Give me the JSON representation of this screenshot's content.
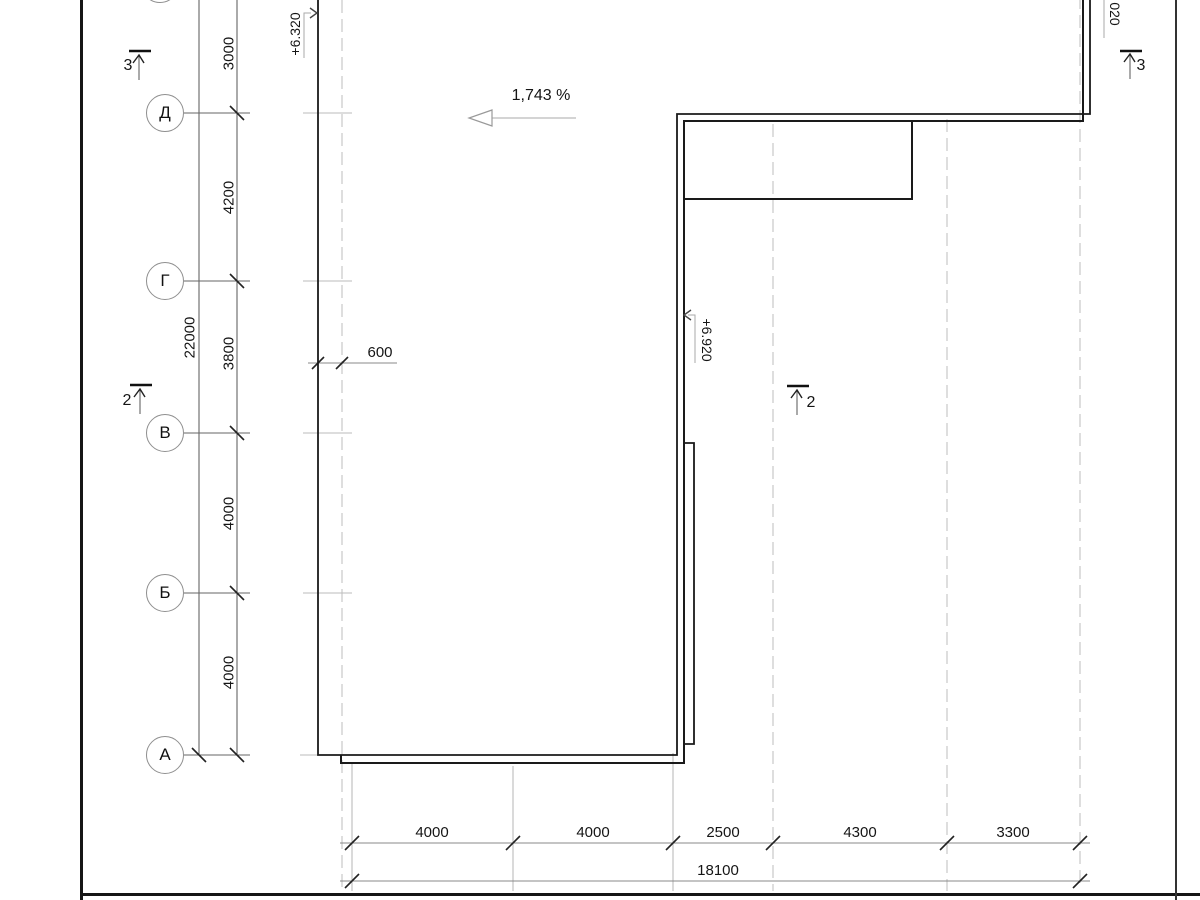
{
  "drawing": {
    "slope": {
      "label": "1,743 %"
    },
    "elevations": {
      "upper_left": "+6.320",
      "inner": "+6.920",
      "top_right_partial": "020"
    },
    "axes": [
      {
        "label": "Д"
      },
      {
        "label": "Г"
      },
      {
        "label": "В"
      },
      {
        "label": "Б"
      },
      {
        "label": "А"
      }
    ],
    "left_dimensions": {
      "total": "22000",
      "segments": [
        "3000",
        "4200",
        "3800",
        "4000",
        "4000"
      ]
    },
    "offset_dimension": "600",
    "bottom_dimensions": {
      "total": "18100",
      "segments": [
        "4000",
        "4000",
        "2500",
        "4300",
        "3300"
      ]
    },
    "sections": {
      "top_left": "3",
      "top_right": "3",
      "mid_left": "2",
      "mid_right": "2"
    },
    "colors": {
      "outline": "#1a1a1a",
      "grid_dash": "#c9c9c9",
      "dim_line": "#888888"
    }
  }
}
